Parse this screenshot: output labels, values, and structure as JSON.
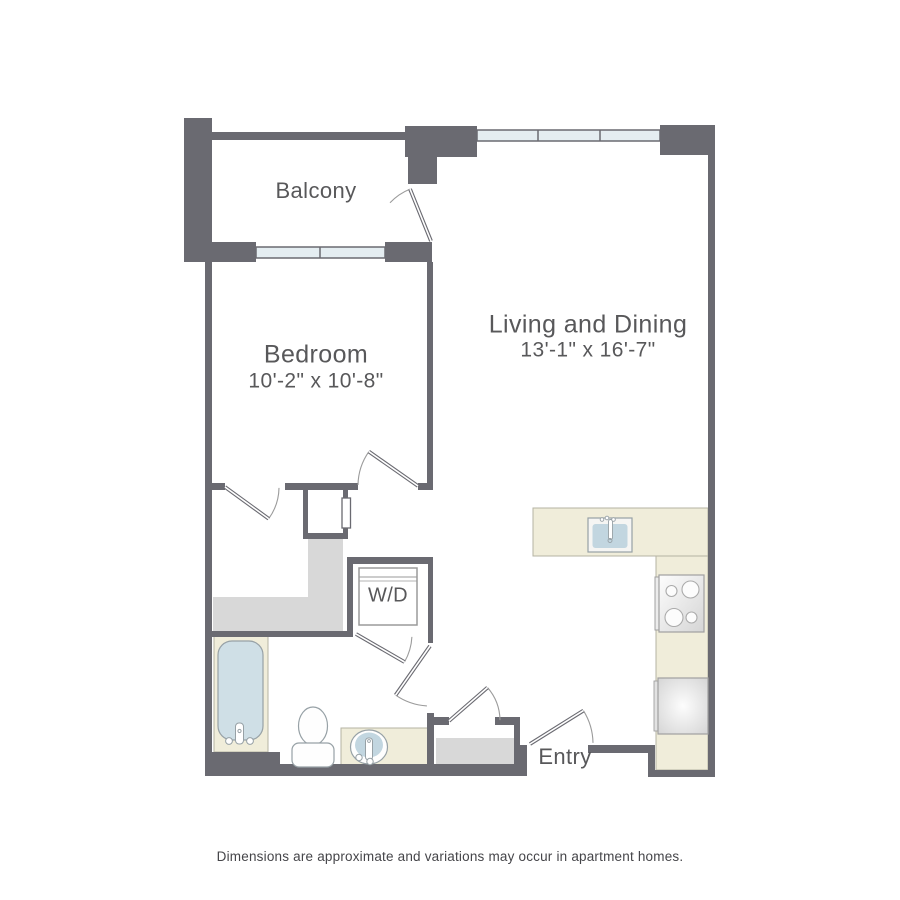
{
  "footer": {
    "text": "Dimensions are approximate and variations may occur in apartment homes."
  },
  "plan": {
    "colors": {
      "wall": "#6a6a71",
      "arc": "#9b9b9b",
      "cream": "#f0edda",
      "creamStroke": "#b5b3a3",
      "gray": "#d8d8d8",
      "glass": "#e4edf1",
      "text": "#58585a"
    },
    "labels": [
      {
        "n": "balcony-label",
        "x": 316,
        "y": 192,
        "size": 22,
        "text": "Balcony"
      },
      {
        "n": "bedroom-label",
        "x": 316,
        "y": 356,
        "size": 25,
        "text": "Bedroom"
      },
      {
        "n": "bedroom-dims",
        "x": 316,
        "y": 382,
        "size": 21,
        "text": "10'-2\" x 10'-8\""
      },
      {
        "n": "living-dining-label",
        "x": 588,
        "y": 326,
        "size": 25,
        "text": "Living and Dining"
      },
      {
        "n": "living-dining-dims",
        "x": 588,
        "y": 351,
        "size": 21,
        "text": "13'-1\" x 16'-7\""
      },
      {
        "n": "washer-dryer-label",
        "x": 388,
        "y": 596,
        "size": 20,
        "text": "W/D"
      },
      {
        "n": "entry-label",
        "x": 565,
        "y": 758,
        "size": 22,
        "text": "Entry"
      }
    ],
    "cream_areas": [
      {
        "n": "tub-surround",
        "x": 214,
        "y": 633,
        "w": 54,
        "h": 119
      },
      {
        "n": "vanity-counter",
        "x": 341,
        "y": 728,
        "w": 89,
        "h": 38
      },
      {
        "n": "kitchen-peninsula-counter",
        "x": 533,
        "y": 508,
        "w": 175,
        "h": 48
      },
      {
        "n": "kitchen-right-counter",
        "x": 656,
        "y": 556,
        "w": 52,
        "h": 214
      }
    ],
    "gray_areas": [
      {
        "n": "closet-floor",
        "path": "M308,539 H343 V632 H213 V597 H308 Z"
      },
      {
        "n": "entry-closet-floor",
        "path": "M436,738 H514 V765 H436 Z"
      }
    ],
    "windows": [
      {
        "n": "bedroom-window",
        "x": 256,
        "y": 247,
        "w": 129,
        "h": 11,
        "dividers": [
          320
        ]
      },
      {
        "n": "living-window",
        "x": 477,
        "y": 130,
        "w": 183,
        "h": 11,
        "dividers": [
          538,
          600
        ]
      }
    ],
    "walls": [
      {
        "n": "balcony-left-column",
        "x": 184,
        "y": 118,
        "w": 28,
        "h": 144
      },
      {
        "n": "balcony-top-wall",
        "x": 212,
        "y": 132,
        "w": 195,
        "h": 8
      },
      {
        "n": "balcony-corner-block",
        "x": 405,
        "y": 126,
        "w": 72,
        "h": 31
      },
      {
        "n": "balcony-corner-tail",
        "x": 408,
        "y": 157,
        "w": 29,
        "h": 27
      },
      {
        "n": "bedroom-sill-left",
        "x": 212,
        "y": 242,
        "w": 44,
        "h": 20
      },
      {
        "n": "bedroom-sill-right",
        "x": 385,
        "y": 242,
        "w": 47,
        "h": 20
      },
      {
        "n": "living-corner-block",
        "x": 660,
        "y": 125,
        "w": 55,
        "h": 30
      },
      {
        "n": "right-wall",
        "x": 708,
        "y": 125,
        "w": 7,
        "h": 652
      },
      {
        "n": "left-wall",
        "x": 205,
        "y": 262,
        "w": 7,
        "h": 514
      },
      {
        "n": "bedroom-living-wall",
        "x": 427,
        "y": 262,
        "w": 6,
        "h": 228
      },
      {
        "n": "bedroom-south-stub",
        "x": 205,
        "y": 483,
        "w": 20,
        "h": 7
      },
      {
        "n": "bedroom-south-mid",
        "x": 285,
        "y": 483,
        "w": 73,
        "h": 7
      },
      {
        "n": "bedroom-south-right",
        "x": 418,
        "y": 483,
        "w": 15,
        "h": 7
      },
      {
        "n": "cell-left-wall",
        "x": 303,
        "y": 490,
        "w": 5,
        "h": 48
      },
      {
        "n": "cell-right-wall",
        "x": 343,
        "y": 490,
        "w": 5,
        "h": 48
      },
      {
        "n": "cell-bottom-wall",
        "x": 303,
        "y": 533,
        "w": 45,
        "h": 6
      },
      {
        "n": "laundry-north-wall",
        "x": 347,
        "y": 557,
        "w": 86,
        "h": 7
      },
      {
        "n": "laundry-west-wall",
        "x": 347,
        "y": 564,
        "w": 6,
        "h": 68
      },
      {
        "n": "laundry-east-wall",
        "x": 428,
        "y": 564,
        "w": 5,
        "h": 79
      },
      {
        "n": "bath-north-wall",
        "x": 212,
        "y": 631,
        "w": 141,
        "h": 6
      },
      {
        "n": "bath-east-wall",
        "x": 427,
        "y": 713,
        "w": 7,
        "h": 54
      },
      {
        "n": "entry-closet-stub",
        "x": 434,
        "y": 717,
        "w": 15,
        "h": 8
      },
      {
        "n": "entry-closet-north",
        "x": 495,
        "y": 717,
        "w": 25,
        "h": 8
      },
      {
        "n": "entry-closet-east",
        "x": 514,
        "y": 725,
        "w": 6,
        "h": 40
      },
      {
        "n": "south-wall-bath-left",
        "x": 205,
        "y": 752,
        "w": 75,
        "h": 24
      },
      {
        "n": "south-wall-bath-right",
        "x": 280,
        "y": 764,
        "w": 247,
        "h": 12
      },
      {
        "n": "entry-step-west",
        "x": 520,
        "y": 745,
        "w": 7,
        "h": 31
      },
      {
        "n": "south-wall-entry",
        "x": 588,
        "y": 745,
        "w": 67,
        "h": 8
      },
      {
        "n": "entry-step-east",
        "x": 648,
        "y": 745,
        "w": 7,
        "h": 32
      },
      {
        "n": "south-wall-kitchen",
        "x": 648,
        "y": 770,
        "w": 67,
        "h": 7
      }
    ],
    "doors": [
      {
        "n": "balcony-door",
        "hinge": [
          431,
          241
        ],
        "r": 56,
        "leafDeg": -112,
        "arcDeg": -137
      },
      {
        "n": "bedroom-door",
        "hinge": [
          418,
          486
        ],
        "r": 60,
        "leafDeg": -145,
        "arcDeg": -179
      },
      {
        "n": "bedroom-closet-door",
        "hinge": [
          225,
          487
        ],
        "r": 54,
        "leafDeg": 36,
        "arcDeg": 1
      },
      {
        "n": "laundry-door",
        "hinge": [
          356,
          634
        ],
        "r": 56,
        "leafDeg": 30,
        "arcDeg": 3
      },
      {
        "n": "bathroom-door",
        "hinge": [
          430,
          646
        ],
        "r": 60,
        "leafDeg": 125,
        "arcDeg": 93
      },
      {
        "n": "entry-door",
        "hinge": [
          530,
          744
        ],
        "r": 63,
        "leafDeg": -32,
        "arcDeg": -1
      },
      {
        "n": "entry-closet-door",
        "hinge": [
          449,
          721
        ],
        "r": 51,
        "leafDeg": -41,
        "arcDeg": -1
      }
    ],
    "fixtures": [
      {
        "t": "rect",
        "n": "pocket-door-panel",
        "x": 342,
        "y": 498,
        "w": 8.5,
        "h": 30,
        "f": "#ffffff",
        "s": "#6a6a71",
        "sw": 1.3
      },
      {
        "t": "rect",
        "n": "bathtub",
        "x": 218,
        "y": 641,
        "w": 45,
        "h": 99,
        "rx": 14,
        "f": "#cfdfe6",
        "s": "#97a1a6",
        "sw": 1.2
      },
      {
        "t": "rect",
        "n": "tub-faucet",
        "x": 235.5,
        "y": 723,
        "w": 8,
        "h": 21,
        "rx": 3.5,
        "f": "#ffffff",
        "s": "#97a1a6",
        "sw": 1
      },
      {
        "t": "circle",
        "n": "tub-knob-left",
        "cx": 229,
        "cy": 741,
        "r": 3.4,
        "f": "#ffffff",
        "s": "#97a1a6",
        "sw": 1
      },
      {
        "t": "circle",
        "n": "tub-knob-right",
        "cx": 250,
        "cy": 741,
        "r": 3.4,
        "f": "#ffffff",
        "s": "#97a1a6",
        "sw": 1
      },
      {
        "t": "circle",
        "n": "tub-drain",
        "cx": 239.5,
        "cy": 731,
        "r": 1.6,
        "f": "none",
        "s": "#97a1a6",
        "sw": 1
      },
      {
        "t": "ellipse",
        "n": "toilet-bowl",
        "cx": 313,
        "cy": 726,
        "rx": 14.5,
        "ry": 19,
        "f": "#fefefe",
        "s": "#97a1a6",
        "sw": 1.2
      },
      {
        "t": "rect",
        "n": "toilet-tank",
        "x": 292,
        "y": 743,
        "w": 42,
        "h": 24,
        "rx": 7,
        "f": "#fefefe",
        "s": "#97a1a6",
        "sw": 1.2
      },
      {
        "t": "ellipse",
        "n": "vanity-sink-rim",
        "cx": 369,
        "cy": 747,
        "rx": 18.5,
        "ry": 17,
        "f": "#fefefe",
        "s": "#97a1a6",
        "sw": 1.2
      },
      {
        "t": "ellipse",
        "n": "vanity-sink-basin",
        "cx": 369,
        "cy": 745,
        "rx": 14,
        "ry": 12.5,
        "f": "#c2d6e0",
        "s": "none",
        "sw": 0
      },
      {
        "t": "rect",
        "n": "vanity-faucet",
        "x": 365.5,
        "y": 738,
        "w": 7,
        "h": 22,
        "rx": 3,
        "f": "#ffffff",
        "s": "#97a1a6",
        "sw": 1
      },
      {
        "t": "circle",
        "n": "vanity-knob-left",
        "cx": 359,
        "cy": 757.5,
        "r": 3.2,
        "f": "#ffffff",
        "s": "#97a1a6",
        "sw": 1
      },
      {
        "t": "circle",
        "n": "vanity-knob-right",
        "cx": 370,
        "cy": 761.5,
        "r": 3.2,
        "f": "#ffffff",
        "s": "#97a1a6",
        "sw": 1
      },
      {
        "t": "circle",
        "n": "vanity-drain",
        "cx": 369,
        "cy": 741,
        "r": 1.4,
        "f": "none",
        "s": "#97a1a6",
        "sw": 0.9
      },
      {
        "t": "rect",
        "n": "kitchen-sink-rim",
        "x": 588,
        "y": 518,
        "w": 44,
        "h": 34,
        "f": "#f5f5f3",
        "s": "#97a1a6",
        "sw": 1.2
      },
      {
        "t": "rect",
        "n": "kitchen-sink-basin",
        "x": 592.5,
        "y": 524,
        "w": 35,
        "h": 24,
        "rx": 3,
        "f": "#c2d6e0",
        "s": "none",
        "sw": 0
      },
      {
        "t": "rect",
        "n": "kitchen-faucet",
        "x": 608.5,
        "y": 519.5,
        "w": 4,
        "h": 20,
        "rx": 2,
        "f": "#ffffff",
        "s": "#97a1a6",
        "sw": 0.9
      },
      {
        "t": "circle",
        "n": "kitchen-knob-1",
        "cx": 602,
        "cy": 519.5,
        "r": 1.8,
        "f": "#ffffff",
        "s": "#97a1a6",
        "sw": 0.9
      },
      {
        "t": "circle",
        "n": "kitchen-knob-2",
        "cx": 607,
        "cy": 518,
        "r": 1.8,
        "f": "#ffffff",
        "s": "#97a1a6",
        "sw": 0.9
      },
      {
        "t": "circle",
        "n": "kitchen-knob-3",
        "cx": 613.5,
        "cy": 519.5,
        "r": 1.8,
        "f": "#ffffff",
        "s": "#97a1a6",
        "sw": 0.9
      },
      {
        "t": "circle",
        "n": "kitchen-sink-drain",
        "cx": 610,
        "cy": 540.5,
        "r": 2,
        "f": "none",
        "s": "#97a1a6",
        "sw": 0.9
      },
      {
        "t": "rect",
        "n": "stove-side-panel",
        "x": 655,
        "y": 577,
        "w": 5,
        "h": 53,
        "f": "#ececec",
        "s": "#a0a0a0",
        "sw": 1
      },
      {
        "t": "rect",
        "n": "stove",
        "x": 659,
        "y": 575,
        "w": 45,
        "h": 57,
        "f": "url(#gStove)",
        "s": "#a0a0a0",
        "sw": 1.2
      },
      {
        "t": "circle",
        "n": "burner-top-left",
        "cx": 671.5,
        "cy": 591,
        "r": 5.5,
        "f": "#fcfcfc",
        "s": "#ababab",
        "sw": 1.1
      },
      {
        "t": "circle",
        "n": "burner-top-right",
        "cx": 690.5,
        "cy": 589.5,
        "r": 8.5,
        "f": "#fcfcfc",
        "s": "#ababab",
        "sw": 1.1
      },
      {
        "t": "circle",
        "n": "burner-bottom-left",
        "cx": 674,
        "cy": 617.5,
        "r": 9,
        "f": "#fcfcfc",
        "s": "#ababab",
        "sw": 1.1
      },
      {
        "t": "circle",
        "n": "burner-bottom-right",
        "cx": 691.5,
        "cy": 617.5,
        "r": 5.5,
        "f": "#fcfcfc",
        "s": "#ababab",
        "sw": 1.1
      },
      {
        "t": "rect",
        "n": "fridge-handle",
        "x": 654,
        "y": 681,
        "w": 4.5,
        "h": 50,
        "f": "#e2e2e2",
        "s": "#a0a0a0",
        "sw": 0.9
      },
      {
        "t": "rect",
        "n": "refrigerator",
        "x": 658,
        "y": 678,
        "w": 50,
        "h": 56,
        "f": "url(#gFridge)",
        "s": "#a0a0a0",
        "sw": 1.2
      },
      {
        "t": "rect",
        "n": "washer-dryer",
        "x": 359,
        "y": 568,
        "w": 58,
        "h": 57,
        "f": "#ffffff",
        "s": "#9a9a9a",
        "sw": 1.5
      },
      {
        "t": "line",
        "n": "washer-dryer-line-1",
        "x1": 359,
        "y1": 577,
        "x2": 417,
        "y2": 577,
        "s": "#9a9a9a",
        "sw": 1
      },
      {
        "t": "line",
        "n": "washer-dryer-line-2",
        "x1": 359,
        "y1": 581,
        "x2": 417,
        "y2": 581,
        "s": "#9a9a9a",
        "sw": 0.8
      }
    ]
  }
}
